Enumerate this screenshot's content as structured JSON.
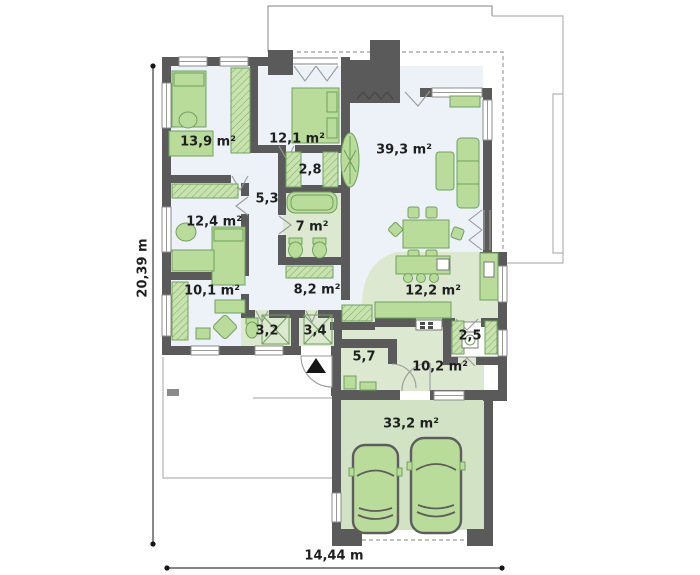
{
  "room_areas": [
    "13,9 m²",
    "12,1 m²",
    "2,8",
    "5,3",
    "7 m²",
    "39,3 m²",
    "12,4 m²",
    "10,1 m²",
    "8,2 m²",
    "3,2",
    "3,4",
    "12,2 m²",
    "2,5",
    "5,7",
    "10,2 m²",
    "33,2 m²"
  ],
  "dimensions": {
    "left": "20,39 m",
    "bottom": "14,44 m"
  },
  "colors": {
    "wall": "#5a5a5a",
    "floor": "#edf2f9",
    "floor_green": "#dce8d0",
    "garage_floor": "#d2e2c4",
    "furniture": "#b9dc9b",
    "furniture_outline": "#70a05e",
    "outline": "#b5b5b5",
    "text": "#1f1f1f"
  }
}
